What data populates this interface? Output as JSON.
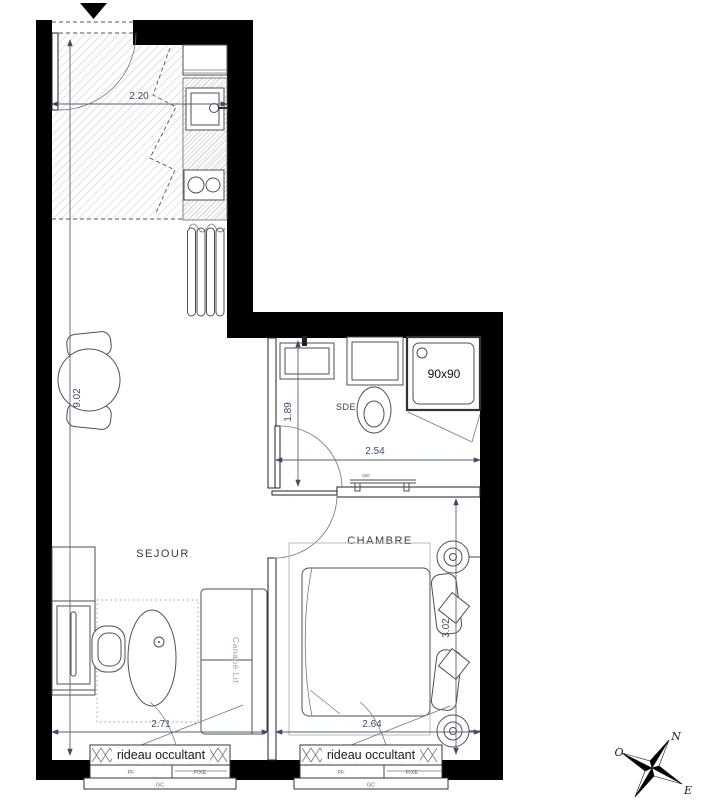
{
  "plan": {
    "rooms": {
      "living": "SEJOUR",
      "bedroom": "CHAMBRE",
      "bathroom": "SDE"
    },
    "fixtures": {
      "shower_label": "90x90",
      "sofa_label": "Canapé Lit",
      "shelf_label": "550"
    },
    "window": {
      "curtain_label": "rideau occultant",
      "pane_left": "PF",
      "pane_right": "FIXE",
      "guardrail": "GC"
    },
    "dimensions": {
      "entry_width": "2.20",
      "overall_depth": "9.02",
      "bath_depth": "1.89",
      "bath_width": "2.54",
      "living_width": "2.71",
      "bedroom_width": "2.64",
      "bedroom_depth": "3.02"
    },
    "compass": {
      "north": "N",
      "west": "O",
      "east": "E"
    },
    "colors": {
      "wall": "#000000",
      "dim_text": "#3d4c68",
      "room_label": "#3a3a3a",
      "sofa_label": "#98a1b3",
      "curtain_label": "#1a1a1a",
      "tiny_label": "#666666"
    }
  }
}
